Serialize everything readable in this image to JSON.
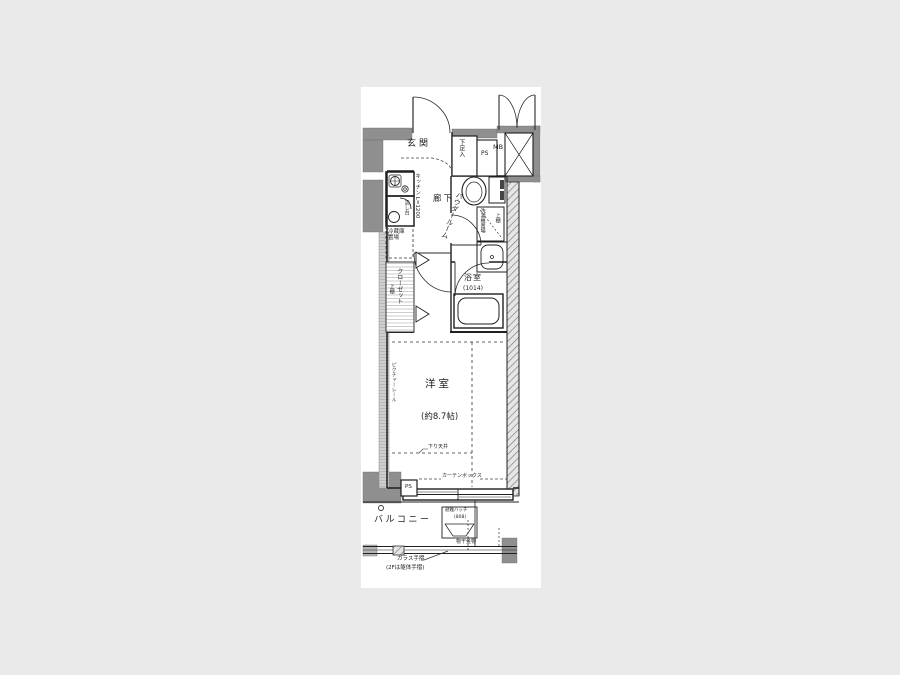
{
  "plan": {
    "title": "ワンルーム間取り図",
    "rooms": {
      "genkan": "玄関",
      "hallway": "廊下",
      "powder_room": "パウダールーム",
      "bathroom": "浴室",
      "bathroom_size": "(1014)",
      "western_room": "洋室",
      "western_room_size": "(約8.7帖)",
      "balcony": "バルコニー"
    },
    "fixtures": {
      "shoe_box": "下足入",
      "pipe_space_top": "PS",
      "meter_box": "MB",
      "kitchen": "キッチン L=1200",
      "sink": "流し台",
      "refrigerator": "冷蔵庫\n置場",
      "washer": "洗濯機置場",
      "washer_shelf": "上棚",
      "closet": "クローゼット",
      "closet_shelf": "上棚",
      "picture_rail": "ピクチャーレール",
      "down_ceiling": "下り天井",
      "curtain_box": "カーテンボックス",
      "pipe_space_bottom": "PS",
      "evacuation_hatch": "避難ハッチ",
      "evacuation_hatch_size": "(808)",
      "laundry_bracket": "物干金物",
      "glass_railing": "ガラス手摺",
      "glass_railing_note": "(2Fは躯体手摺)"
    },
    "colors": {
      "background": "#eaeaea",
      "canvas": "#ffffff",
      "wall_dark": "#8f8f8f",
      "wall_light": "#cfcfcf",
      "line": "#1f1f1f"
    }
  }
}
